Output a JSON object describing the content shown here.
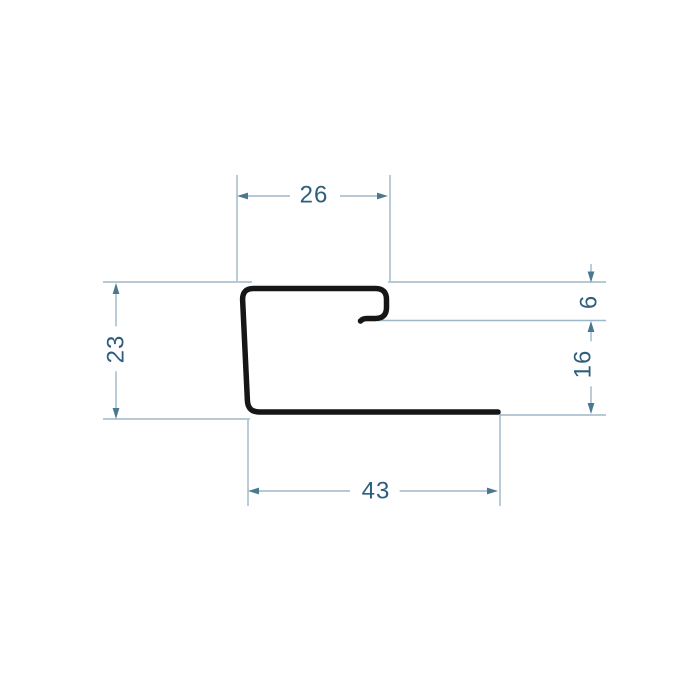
{
  "drawing": {
    "title": "",
    "kind": "profile-cross-section-technical-drawing"
  },
  "dimensions": {
    "top_width": "26",
    "left_height": "23",
    "right_upper": "6",
    "right_lower": "16",
    "bottom_width": "43"
  },
  "colors": {
    "background": "#ffffff",
    "profile_stroke": "#161616",
    "dimension_line": "#9db7c7",
    "arrowhead": "#4a7890",
    "dimension_text": "#2e5e7e"
  }
}
